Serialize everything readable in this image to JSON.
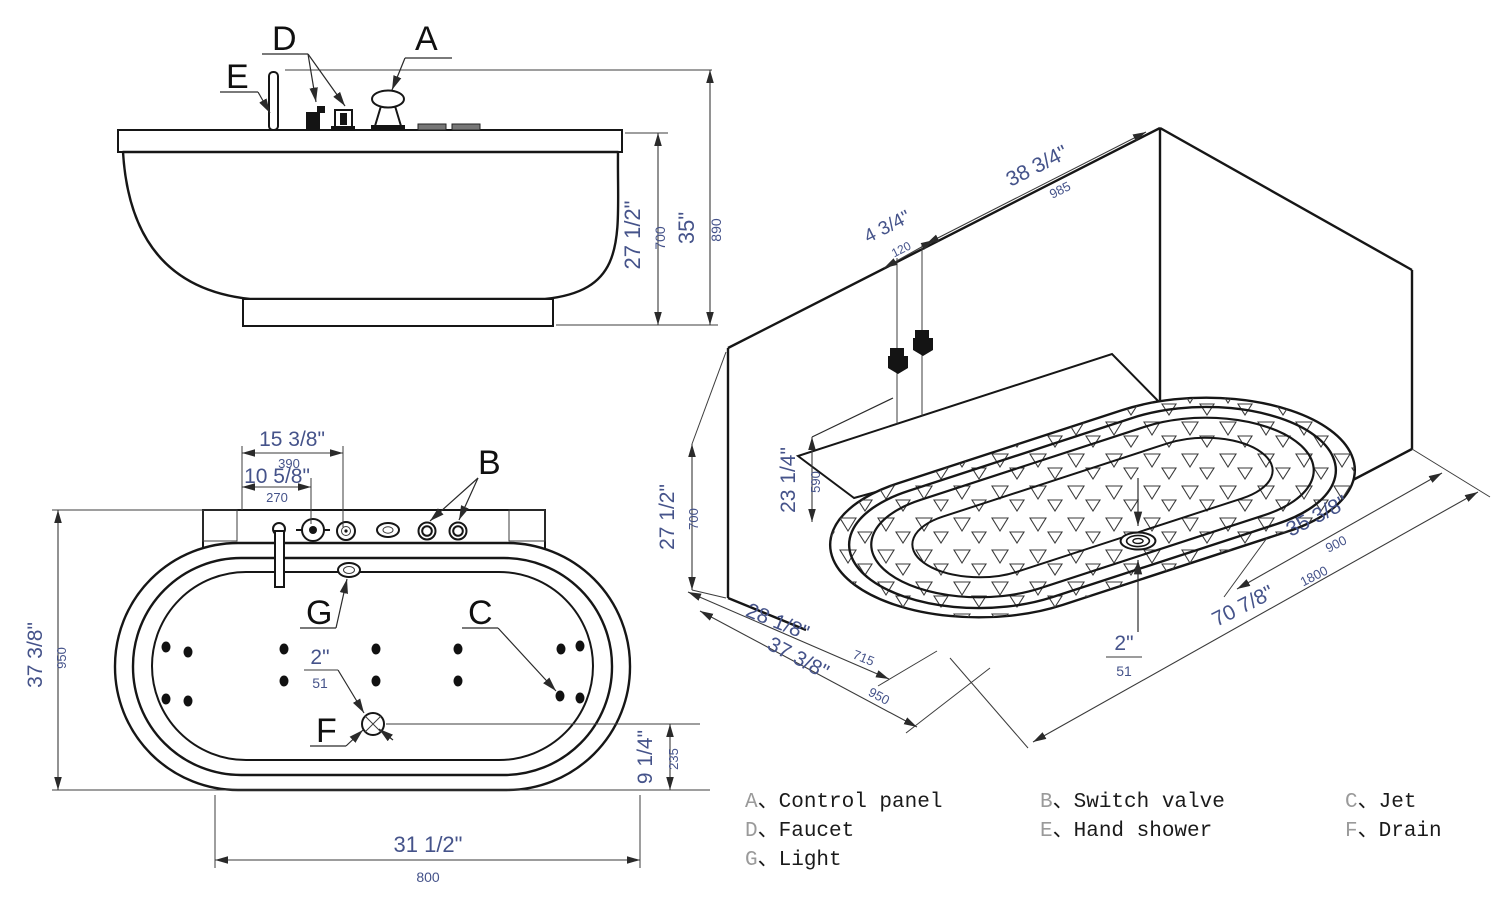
{
  "title": "Bathtub installation drawing, three views",
  "colors": {
    "line": "#161616",
    "dim_text": "#45538a",
    "legend_letter": "#9a9a9a"
  },
  "views": {
    "front": {
      "callouts": [
        "D",
        "A",
        "E"
      ],
      "dims": [
        {
          "in": "27 1/2\"",
          "mm": "700"
        },
        {
          "in": "35\"",
          "mm": "890"
        }
      ]
    },
    "plan": {
      "callouts": [
        "B",
        "G",
        "C",
        "F"
      ],
      "dims": [
        {
          "in": "15 3/8\"",
          "mm": "390"
        },
        {
          "in": "10 5/8\"",
          "mm": "270"
        },
        {
          "in": "37 3/8\"",
          "mm": "950"
        },
        {
          "in": "31 1/2\"",
          "mm": "800"
        },
        {
          "in": "9 1/4\"",
          "mm": "235"
        },
        {
          "in": "2\"",
          "mm": "51"
        }
      ]
    },
    "iso": {
      "dims": [
        {
          "in": "38 3/4\"",
          "mm": "985"
        },
        {
          "in": "4 3/4\"",
          "mm": "120"
        },
        {
          "in": "23 1/4\"",
          "mm": "590"
        },
        {
          "in": "27 1/2\"",
          "mm": "700"
        },
        {
          "in": "28 1/8\"",
          "mm": "715"
        },
        {
          "in": "37 3/8\"",
          "mm": "950"
        },
        {
          "in": "35 3/8\"",
          "mm": "900"
        },
        {
          "in": "70 7/8\"",
          "mm": "1800"
        },
        {
          "in": "2\"",
          "mm": "51"
        }
      ]
    }
  },
  "legend": {
    "separator": "、",
    "items": [
      {
        "key": "A",
        "label": "Control panel"
      },
      {
        "key": "B",
        "label": "Switch valve"
      },
      {
        "key": "C",
        "label": "Jet"
      },
      {
        "key": "D",
        "label": "Faucet"
      },
      {
        "key": "E",
        "label": "Hand shower"
      },
      {
        "key": "F",
        "label": "Drain"
      },
      {
        "key": "G",
        "label": "Light"
      }
    ]
  }
}
